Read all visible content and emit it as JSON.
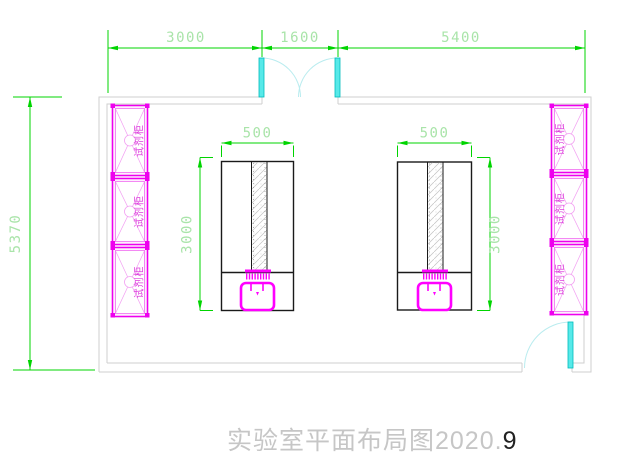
{
  "title": {
    "main": "实验室平面布局图2020.",
    "suffix": "9"
  },
  "dimensions": {
    "top": {
      "left": "3000",
      "middle": "1600",
      "right": "5400"
    },
    "overall_height": "5370"
  },
  "benches": {
    "left": {
      "width": "500",
      "depth": "3000"
    },
    "right": {
      "width": "500",
      "depth": "3000"
    }
  },
  "cabinets": {
    "left": [
      {
        "label": "试剂柜"
      },
      {
        "label": "试剂柜"
      },
      {
        "label": "试剂柜"
      }
    ],
    "right": [
      {
        "label": "试剂柜"
      },
      {
        "label": "试剂柜"
      },
      {
        "label": "试剂柜"
      }
    ]
  },
  "colors": {
    "dimension_line": "#00d400",
    "dimension_text": "#a9e4a9",
    "wall": "#cfcfcf",
    "fixture_magenta": "#ff00ff",
    "cabinet_magenta": "#ee00ee",
    "door_cyan": "#57e9e9",
    "bench_outline": "#1a1a1a",
    "title_text": "#c6c6c6"
  }
}
